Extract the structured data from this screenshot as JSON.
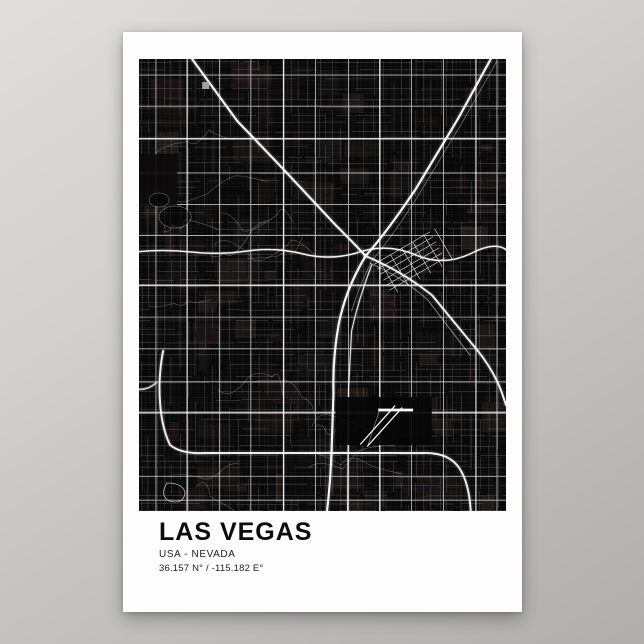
{
  "poster": {
    "title": "LAS VEGAS",
    "subtitle": "USA - NEVADA",
    "coordinates": "36.157 N° / -115.182 E°"
  },
  "colors": {
    "backdrop_top": "#dfdedd",
    "backdrop_bottom": "#b0aead",
    "poster_paper": "#fdfdfd",
    "map_background": "#0a0909",
    "road": "#ffffff",
    "title_text": "#0d0d0d"
  },
  "map_art": {
    "type": "city-street-map",
    "city": "Las Vegas",
    "width": 366,
    "height": 452,
    "seed": 20240157,
    "patch_count": 130,
    "patch_palette": [
      "#151011",
      "#1a1214",
      "#131313",
      "#1b1717",
      "#0f0d0d",
      "#1e1a16",
      "#120e0f",
      "#181212"
    ],
    "minor_grid": {
      "step": 3.9,
      "opacity": 0.11,
      "width": 0.35,
      "gap_prob": 0.24
    },
    "collector_grid": {
      "step": 7.7,
      "opacity": 0.27,
      "width": 0.5,
      "gap_prob": 0.3
    },
    "arterials": {
      "vx": [
        16,
        48,
        80,
        112,
        144,
        176,
        208,
        240,
        272,
        304,
        336,
        357
      ],
      "hy": [
        16,
        48,
        80,
        113,
        145,
        176,
        226,
        258,
        290,
        322,
        354,
        418,
        441
      ],
      "opacity": 0.72,
      "width": 0.85
    },
    "suburban_curve_count": 16,
    "freeways": [
      {
        "name": "us95-northwest",
        "d": "M50,-4 L98,62 L140,106 L196,166 Q216,186 226,197",
        "w": 2.2,
        "o": 0.95
      },
      {
        "name": "i15-north",
        "d": "M353,-4 L318,60 L276,130 Q248,172 226,197",
        "w": 2.2,
        "o": 0.95
      },
      {
        "name": "i15-south",
        "d": "M226,197 Q206,230 199,266 Q193,300 194,334 L192,392 Q191,424 187,456",
        "w": 2.2,
        "o": 0.95
      },
      {
        "name": "us95-east",
        "d": "M226,197 Q262,212 292,236 L338,292 Q354,312 362,334 L366,346",
        "w": 2.0,
        "o": 0.92
      },
      {
        "name": "us95-east-frontage",
        "d": "M230,204 Q264,219 288,241 L330,296",
        "w": 0.7,
        "o": 0.5
      },
      {
        "name": "charleston-blvd",
        "d": "M-4,193 Q24,190 52,193 T108,192 T164,195 T220,193 T276,196 T332,194 T370,195",
        "w": 1.5,
        "o": 0.95
      },
      {
        "name": "beltway-west-south",
        "d": "M24,292 Q19,318 21,344 Q23,370 31,386 Q42,395 64,394 L286,394 Q310,394 320,410 Q330,426 331,456",
        "w": 2.0,
        "o": 0.92
      },
      {
        "name": "beltway-west-stub",
        "d": "M-4,330 Q8,332 17,324",
        "w": 1.6,
        "o": 0.8
      },
      {
        "name": "las-vegas-blvd",
        "d": "M232,206 Q219,240 212,272 L209,330 L208,456",
        "w": 1.2,
        "o": 0.85
      },
      {
        "name": "rail-line",
        "d": "M357,2 L322,64 L280,134 Q254,176 232,202 Q220,226 212,252",
        "w": 0.5,
        "o": 0.45
      }
    ],
    "features": [
      {
        "tag": "rect",
        "name": "park-block-nw",
        "x": 0,
        "y": 95,
        "w": 38,
        "h": 52,
        "fill": "#0c0b0b",
        "o": 0.9
      },
      {
        "tag": "rect",
        "name": "airport-grounds",
        "x": 196,
        "y": 338,
        "w": 96,
        "h": 48,
        "fill": "#060606",
        "o": 0.92
      },
      {
        "tag": "path",
        "name": "downtown-diagonal-grid",
        "d": "M235,205l55,-32M238,210l55,-32M241,215l55,-32M244,221l55,-32M247,226l55,-32M250,231l55,-32M240,202l18,31M251,196l18,31M262,189l18,31M273,183l18,31M284,176l18,31M295,170l18,31",
        "w": 0.7,
        "o": 0.8
      },
      {
        "tag": "path",
        "name": "airport-runway-horizontal",
        "d": "M240,351H272",
        "w": 2.8,
        "o": 1
      },
      {
        "tag": "path",
        "name": "airport-runway-diagonal-1",
        "d": "M221,385 L255,347",
        "w": 1.3,
        "o": 0.95
      },
      {
        "tag": "path",
        "name": "airport-runway-diagonal-2",
        "d": "M228,387 L262,349",
        "w": 1.3,
        "o": 0.95
      },
      {
        "tag": "path",
        "name": "airport-taxiway",
        "d": "M240,351 L228,387",
        "w": 0.6,
        "o": 0.6
      },
      {
        "tag": "rect",
        "name": "plaza-square",
        "x": 63,
        "y": 23,
        "w": 7,
        "h": 7,
        "fill": "#aaaaaa",
        "o": 0.95
      },
      {
        "tag": "ellipse",
        "name": "golf-loop-1",
        "cx": 36,
        "cy": 158,
        "rx": 16,
        "ry": 11,
        "w": 0.5,
        "o": 0.5
      },
      {
        "tag": "ellipse",
        "name": "golf-loop-2",
        "cx": 20,
        "cy": 141,
        "rx": 10,
        "ry": 7,
        "w": 0.5,
        "o": 0.45
      },
      {
        "tag": "path",
        "name": "pond-loop",
        "d": "M28,424 Q20,436 30,442 Q44,446 46,434 Q44,424 28,424",
        "w": 0.8,
        "o": 0.7
      }
    ]
  }
}
